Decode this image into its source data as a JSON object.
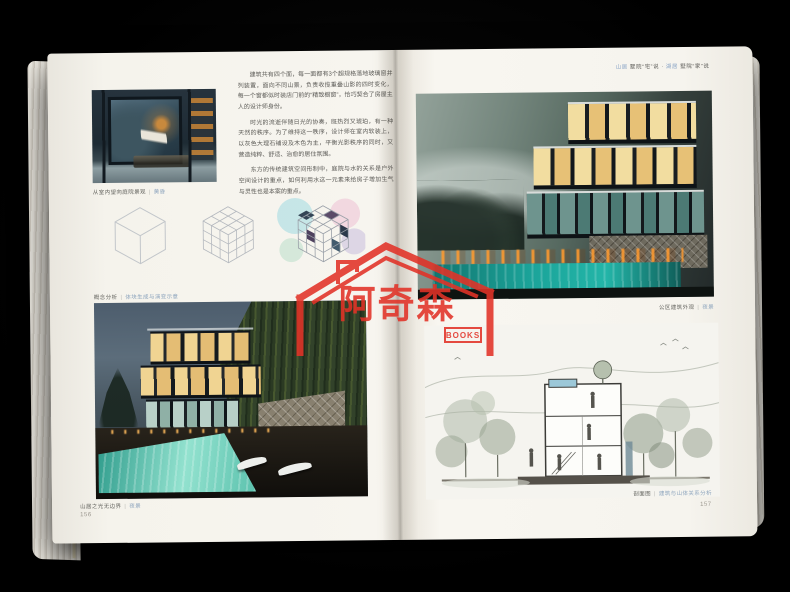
{
  "book": {
    "divider": "|",
    "left_page": {
      "paragraphs": [
        "建筑共有四个面，每一面都有3个超规格落地玻璃窗并列装置，面向不同山景，负责收揽重叠山影的四时变化，每一个窗都似时装店门前的“精致橱窗”，恰巧契合了房屋主人的设计师身份。",
        "时光的流逝伴随日光的协奏，既热烈又琥珀，有一种天然的秩序。为了维持这一秩序，设计师在室内软装上，以灰色大理石铺设及木色为主，平衡光影秩序的同时，又营造纯粹、舒适、治愈的居住氛围。",
        "东方的传统建筑空间形制中，庭院与水的关系是户外空间设计的重点，如何利用水这一元素来给房子增加生气与灵性也是本案的重点。"
      ],
      "captions": {
        "interior": {
          "label": "从室内望向庭院景观",
          "sub": "黄昏"
        },
        "concept": {
          "label": "概念分析",
          "sub": "体块生成与演变示意"
        },
        "villa_night": {
          "label": "山居之光无边界",
          "sub": "夜景"
        }
      },
      "page_number": "156"
    },
    "right_page": {
      "header": {
        "blue1": "山居",
        "dark1": "墅院“宅”说",
        "sep": "·",
        "blue2": "湖居",
        "dark2": "墅院“家”说"
      },
      "captions": {
        "exterior": {
          "label": "公区建筑外观",
          "sub": "夜景"
        },
        "section": {
          "label": "剖面图",
          "sub": "建筑与山体关系分析"
        }
      },
      "page_number": "157"
    }
  },
  "watermark": {
    "title": "阿奇森",
    "subtitle": "BOOKS",
    "color": "#e23227"
  }
}
